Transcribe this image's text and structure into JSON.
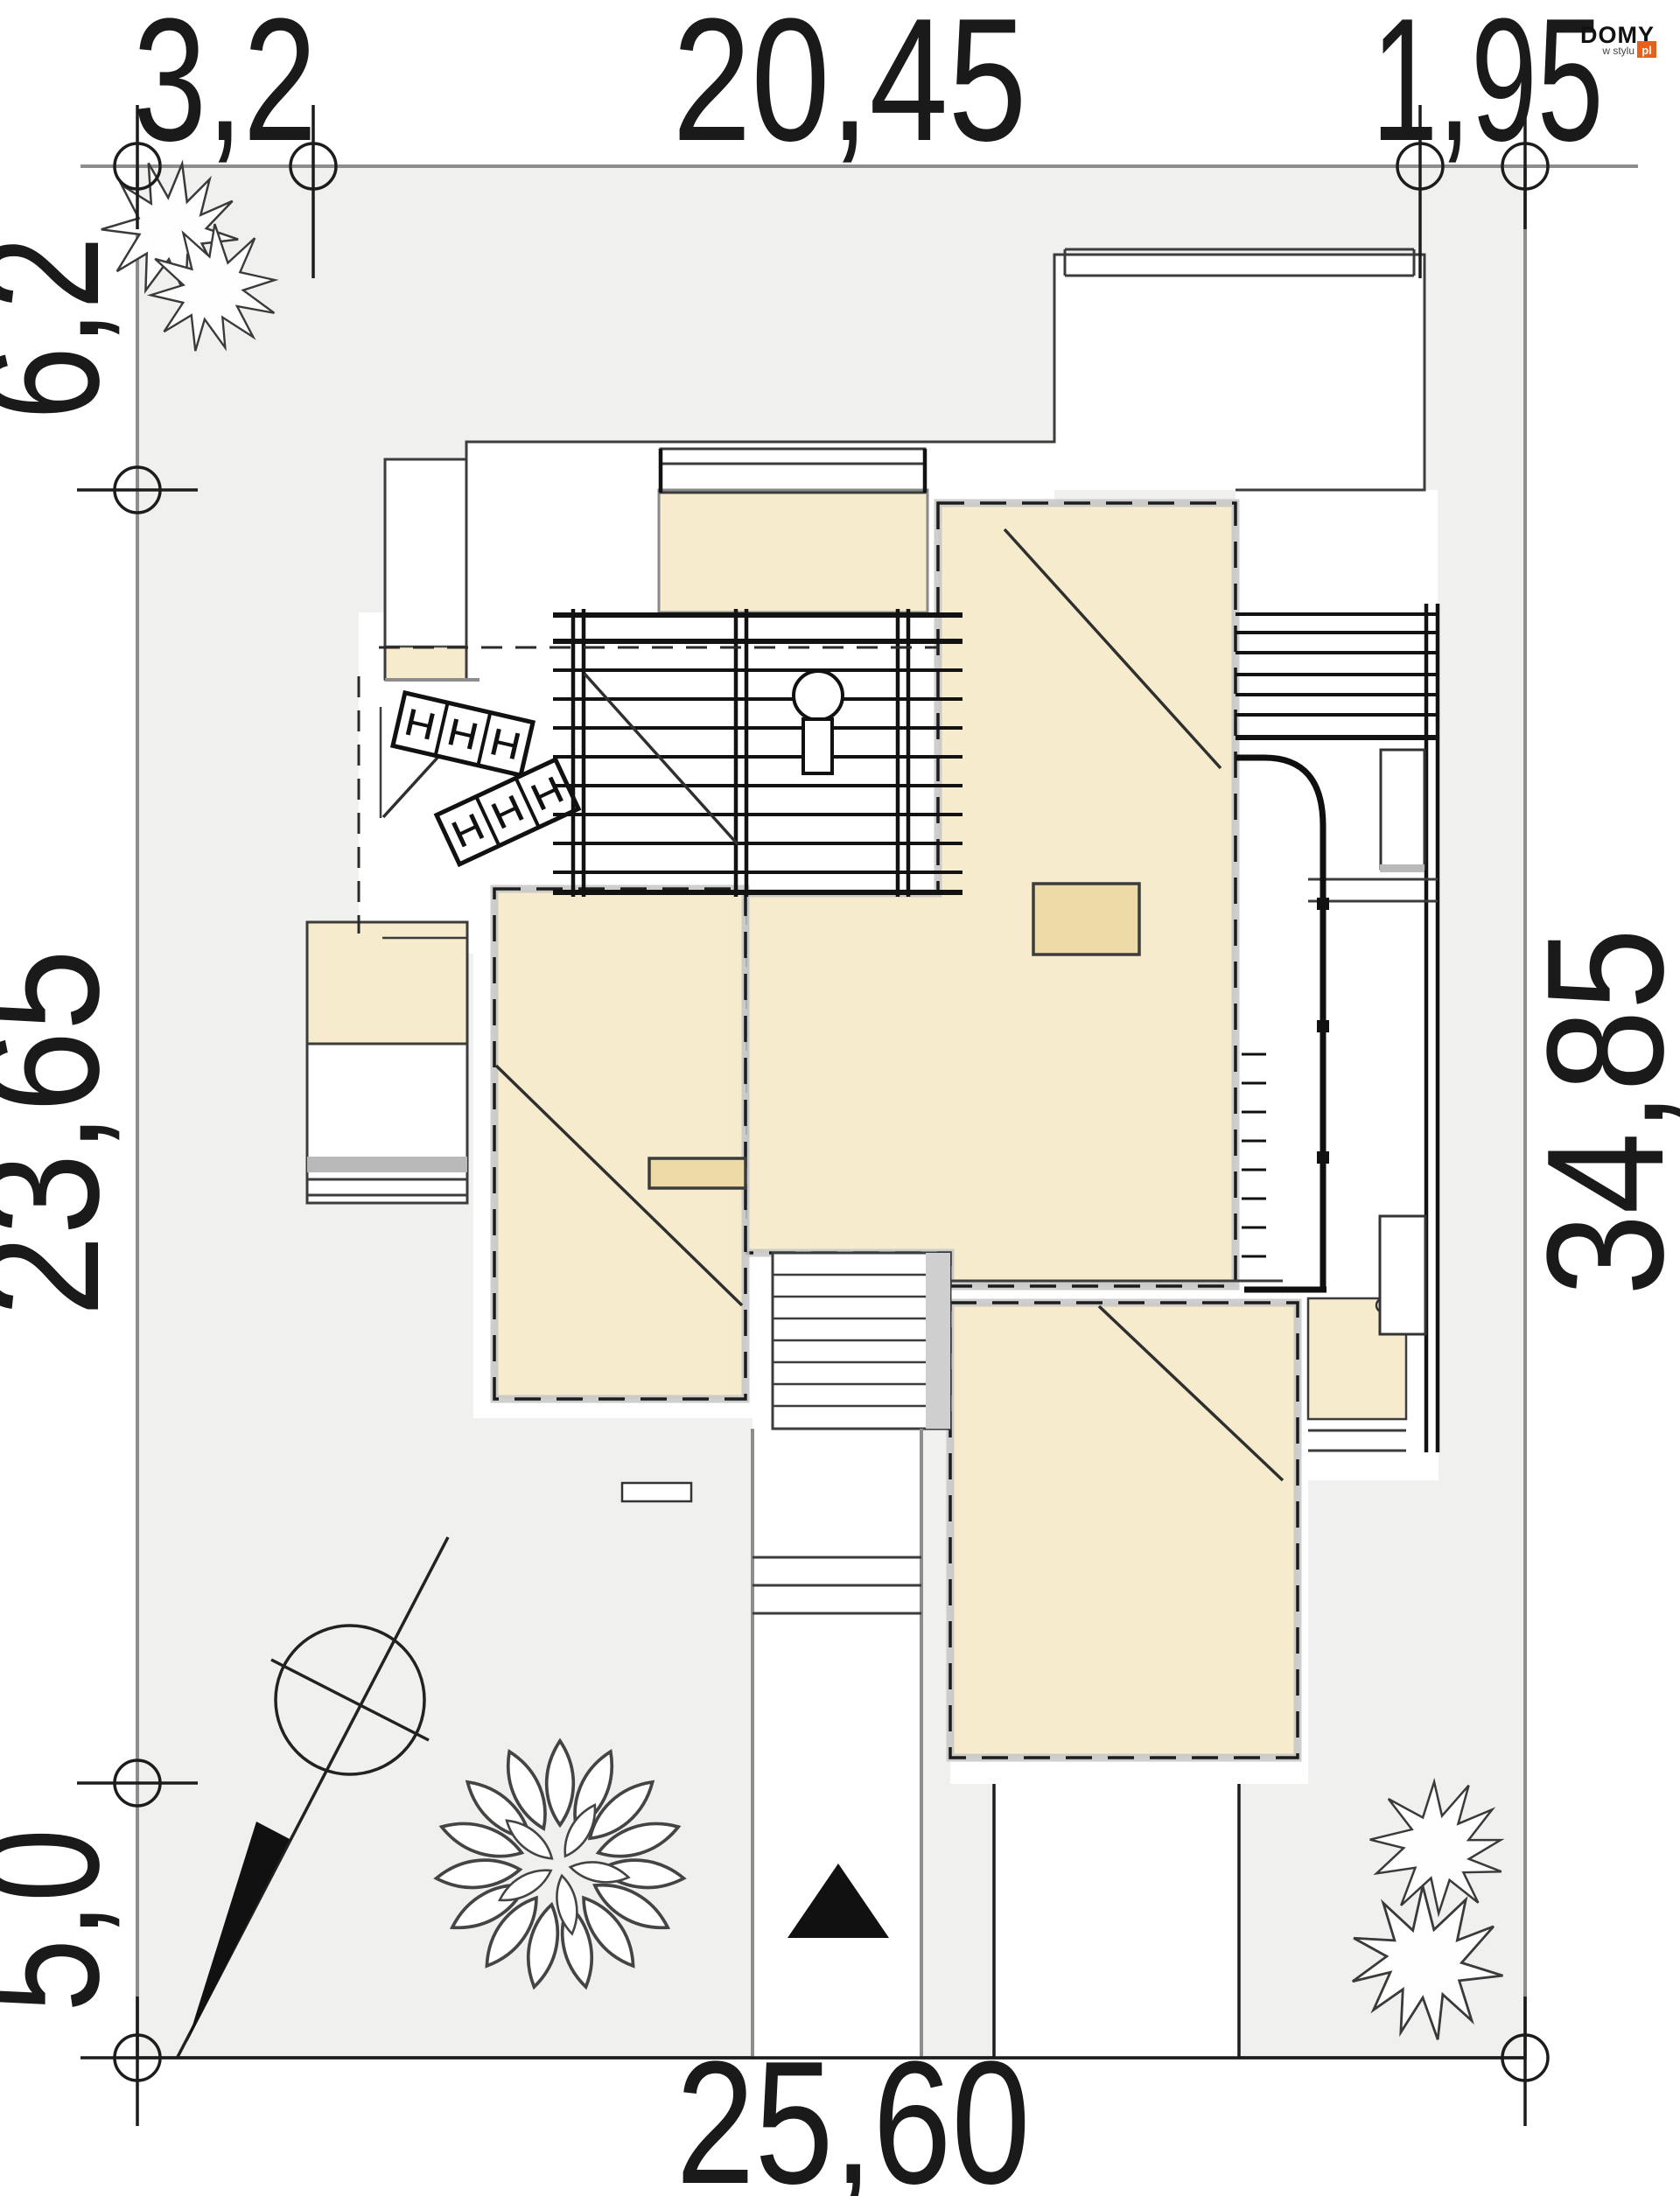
{
  "logo": {
    "brand": "DOMY",
    "tagline": "w stylu",
    "tld": "pl"
  },
  "dimensions": {
    "top_left": "3,2",
    "top_middle": "20,45",
    "top_right": "1,95",
    "left_upper": "6,2",
    "left_middle": "23,65",
    "left_lower": "5,0",
    "right_full": "34,85",
    "bottom": "25,60"
  },
  "colors": {
    "plot-fill": "#f0f0ee",
    "plot-border": "#8d8d8d",
    "roof-fill": "#f6ebcd",
    "roof-accent": "#eddaa6",
    "wall-outline": "#3c3c3c",
    "eave-band": "#c6c6c6",
    "dim-text": "#1a1a1a",
    "logo-orange": "#e8611a"
  }
}
